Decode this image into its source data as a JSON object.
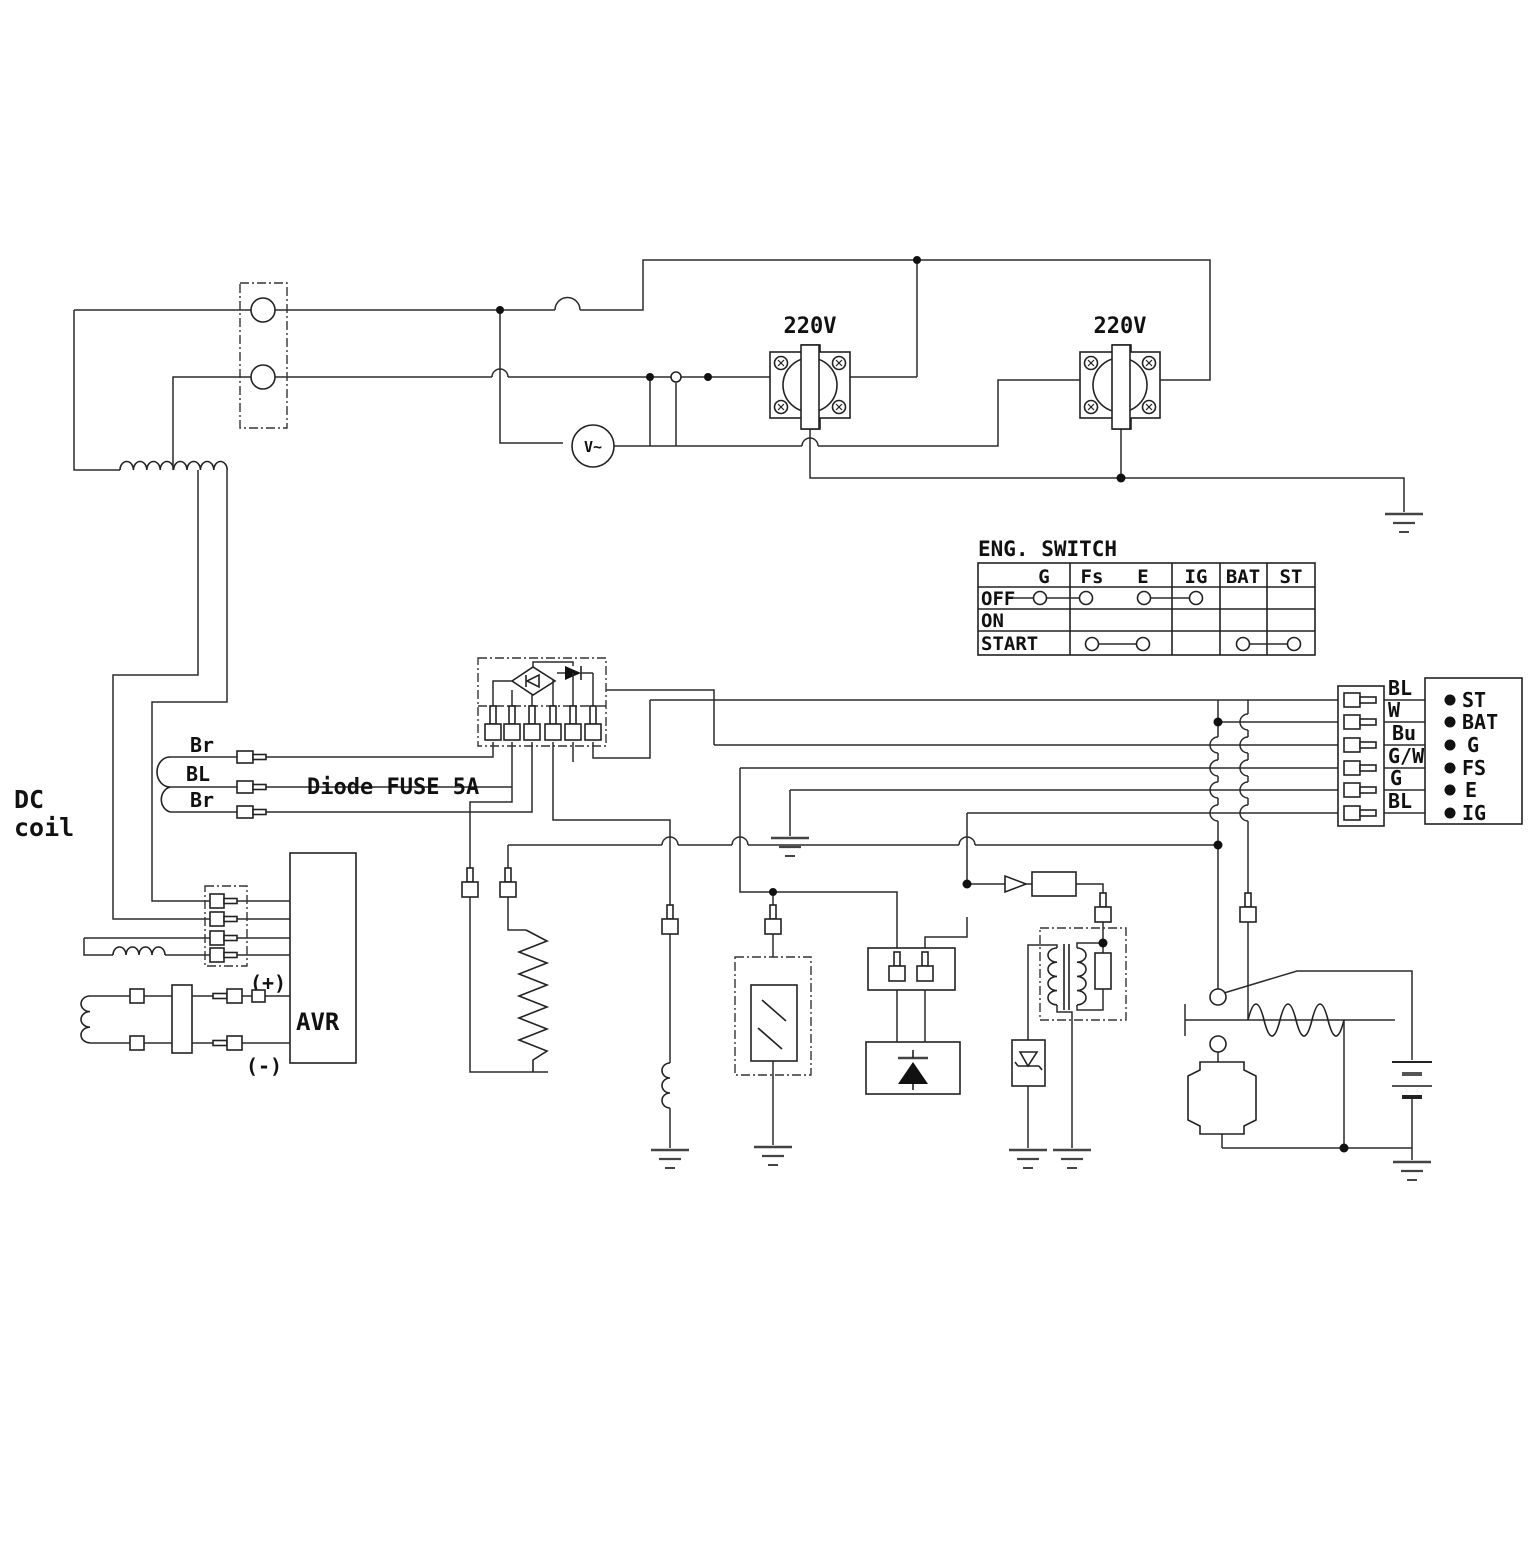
{
  "diagram": {
    "title_note": "generator wiring schematic",
    "labels": {
      "dc_line1": "DC",
      "dc_line2": "coil",
      "wire_br_top": "Br",
      "wire_bl": "BL",
      "wire_br_bottom": "Br",
      "diode_fuse": "Diode FUSE 5A",
      "avr": "AVR",
      "plus": "(+)",
      "minus": "(-)",
      "outlet1_voltage": "220V",
      "outlet2_voltage": "220V",
      "voltmeter": "V~",
      "eng_switch_title": "ENG. SWITCH"
    },
    "eng_switch_table": {
      "columns": [
        "G",
        "Fs",
        "E",
        "IG",
        "BAT",
        "ST"
      ],
      "rows": [
        "OFF",
        "ON",
        "START"
      ],
      "connections": [
        {
          "row": "OFF",
          "from": "G",
          "to": "Fs"
        },
        {
          "row": "OFF",
          "from": "E",
          "to": "IG"
        },
        {
          "row": "START",
          "from": "Fs",
          "to": "E"
        },
        {
          "row": "START",
          "from": "BAT",
          "to": "ST"
        }
      ]
    },
    "right_connector": {
      "wire_labels": [
        "BL",
        "W",
        "Bu",
        "G/W",
        "G",
        "BL"
      ],
      "terminal_labels": [
        "ST",
        "BAT",
        "G",
        "FS",
        "E",
        "IG"
      ]
    }
  }
}
